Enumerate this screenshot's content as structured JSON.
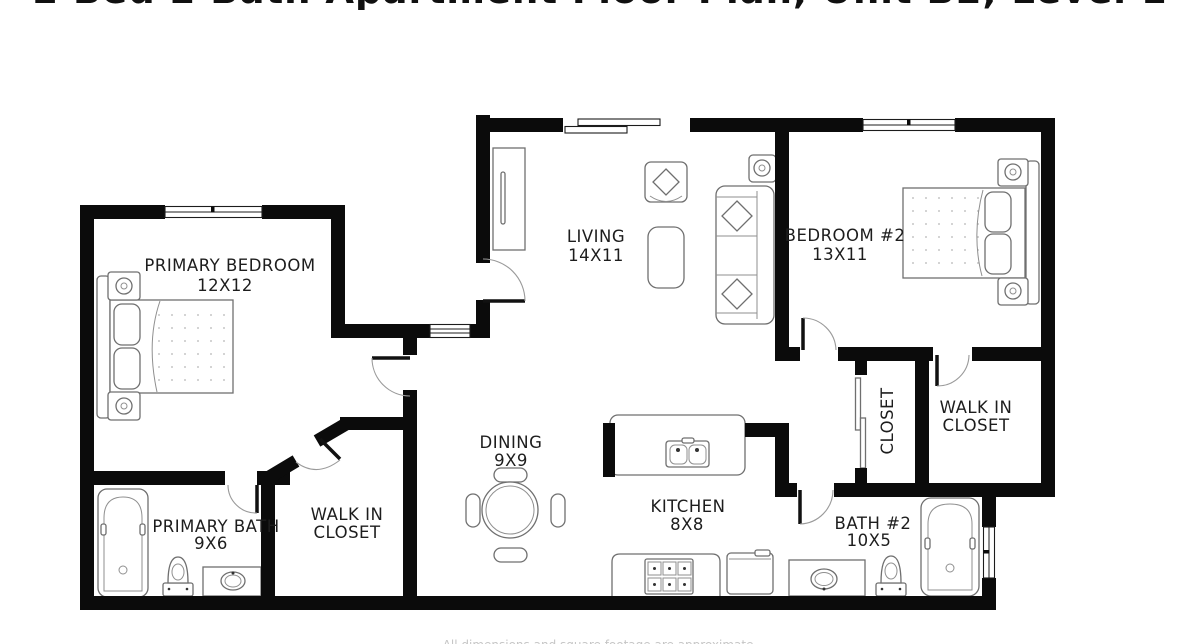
{
  "meta": {
    "type": "floor-plan"
  },
  "header": {
    "cropped_title": "2 Bed 2 Bath Apartment Floor Plan, Unit B2, Level 1"
  },
  "footer": {
    "cropped_disclaimer": "All dimensions and square footage are approximate."
  },
  "rooms": {
    "primary_bedroom": {
      "name": "PRIMARY BEDROOM",
      "dims": "12X12"
    },
    "living": {
      "name": "LIVING",
      "dims": "14X11"
    },
    "bedroom_2": {
      "name": "BEDROOM #2",
      "dims": "13X11"
    },
    "dining": {
      "name": "DINING",
      "dims": "9X9"
    },
    "kitchen": {
      "name": "KITCHEN",
      "dims": "8X8"
    },
    "primary_bath": {
      "name": "PRIMARY BATH",
      "dims": "9X6"
    },
    "walk_in_closet_primary": {
      "line1": "WALK IN",
      "line2": "CLOSET"
    },
    "walk_in_closet_2": {
      "line1": "WALK IN",
      "line2": "CLOSET"
    },
    "closet": {
      "name": "CLOSET"
    },
    "bath_2": {
      "name": "BATH #2",
      "dims": "10X5"
    }
  },
  "colors": {
    "wall": "#0b0b0b",
    "furniture_line": "#6f6f6f",
    "label_text": "#1d1d1d",
    "background": "#ffffff"
  }
}
